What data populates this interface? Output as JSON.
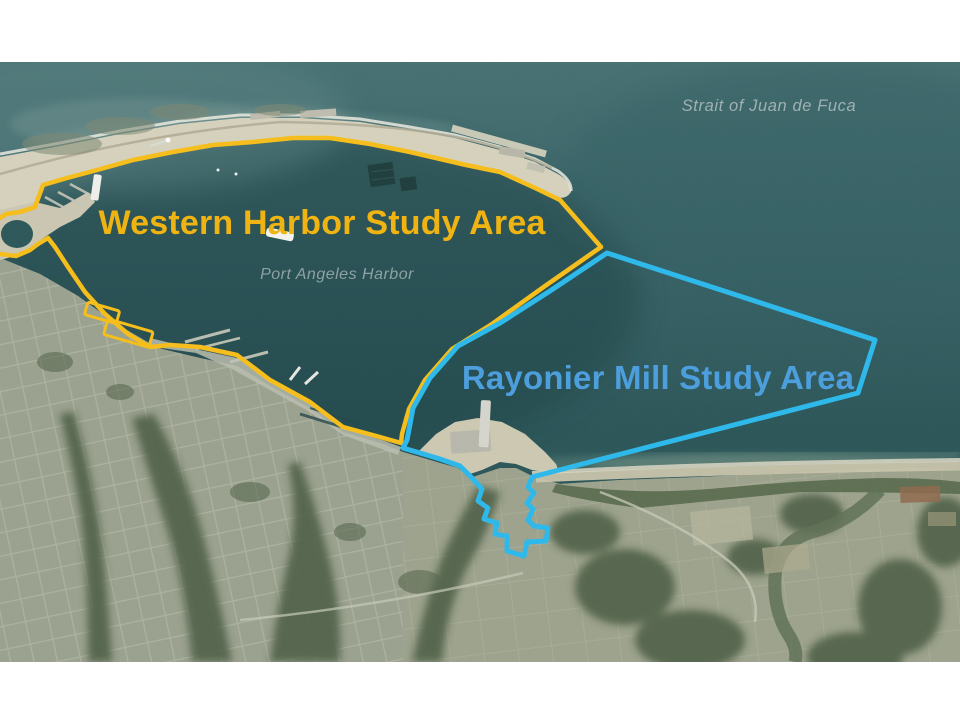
{
  "map": {
    "type": "satellite-aerial",
    "labels": {
      "strait": "Strait of Juan de Fuca",
      "harbor": "Port Angeles Harbor",
      "western_area": "Western Harbor Study Area",
      "rayonier_area": "Rayonier Mill Study Area"
    },
    "colors": {
      "western_outline": "#F5BE1C",
      "western_label": "#EFB412",
      "rayonier_outline": "#2FB9EB",
      "rayonier_label": "#4D9EDC",
      "strait_label": "#9FB1B2",
      "harbor_label": "#8CA2A3"
    }
  }
}
